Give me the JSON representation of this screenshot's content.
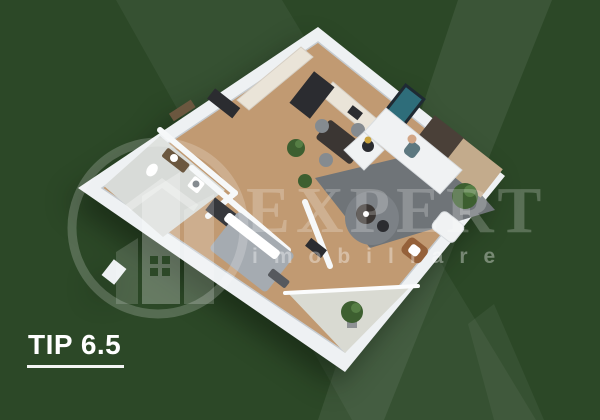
{
  "image": {
    "kind": "real-estate-apartment-3d-floorplan-render"
  },
  "label": {
    "text": "TIP 6.5"
  },
  "watermark": {
    "brand": "EXPERT",
    "brand_sub": "imobiliare",
    "logo": "house-buildings-logo"
  },
  "floorplan": {
    "view": "isometric-3d",
    "rooms": [
      "kitchen",
      "dining area",
      "living room",
      "bedroom",
      "bathroom",
      "hallway",
      "balcony"
    ]
  },
  "colors": {
    "bg": "#2c4827",
    "wall": "#eef1f3",
    "wood": "#c19a72",
    "tile": "#d8dbd8",
    "balconyTile": "#d9dad2",
    "rug": "#6f7478",
    "rugRound": "#7c8186",
    "counter": "#eae4d8",
    "darkFurn": "#2b2c30",
    "wardrobe": "#36383c",
    "tableDark": "#3b3633",
    "chairGray": "#858b90",
    "sofa": "#f0f2f3",
    "bed": "#a5abb1",
    "bedDark": "#56595e",
    "plant": "#3d5f30",
    "plantLight": "#567e45",
    "pot": "#8e9194",
    "art": "#2e6d7a",
    "artFrame": "#1f2a33",
    "panel": "#4a4038",
    "woodWall": "#c3ab8c",
    "chairOrange": "#95613a",
    "door": "#6b573f",
    "gold": "#c9a23c",
    "person": "#5d7880",
    "skin": "#d2a686"
  }
}
